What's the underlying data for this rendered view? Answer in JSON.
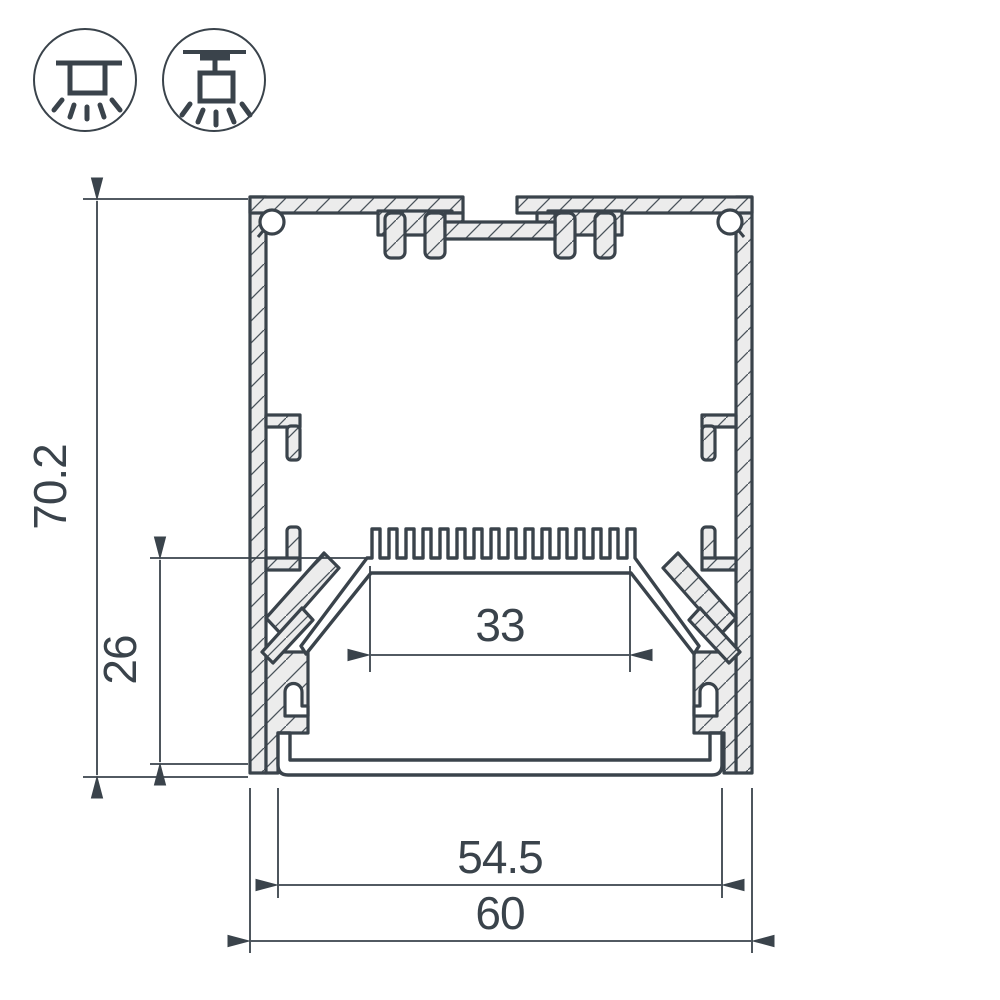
{
  "drawing": {
    "type": "led-profile-cross-section",
    "colors": {
      "line": "#3a434b",
      "metal_fill": "#ececec",
      "background": "#ffffff"
    },
    "icons": [
      {
        "name": "surface-mount-icon"
      },
      {
        "name": "pendant-mount-icon"
      }
    ],
    "dimensions": {
      "overall_height": "70.2",
      "inner_height": "26",
      "led_shelf_width": "33",
      "diffuser_width": "54.5",
      "overall_width": "60"
    }
  }
}
